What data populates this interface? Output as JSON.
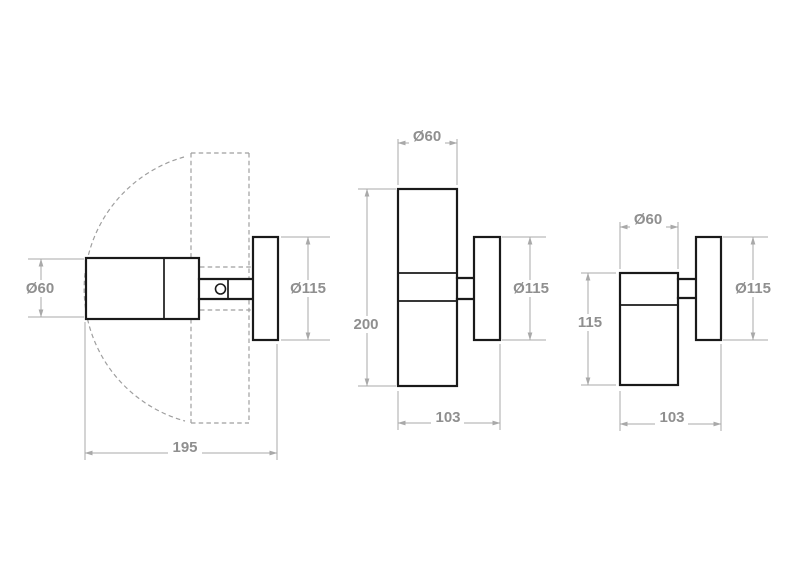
{
  "drawing": {
    "type": "wall-spotlight dimensional drawing, three orthographic views",
    "views": {
      "side": {
        "head_diameter": "Ø60",
        "backplate_diameter": "Ø115",
        "projection": "195"
      },
      "twin": {
        "head_diameter": "Ø60",
        "height": "200",
        "backplate_diameter": "Ø115",
        "depth": "103"
      },
      "single": {
        "head_diameter": "Ø60",
        "height": "115",
        "backplate_diameter": "Ø115",
        "depth": "103"
      }
    },
    "colors": {
      "outline": "#1a1a1a",
      "dimension_lines": "#a9a9a9",
      "dimension_text": "#8f8f8f",
      "dashed_swivel": "#9f9f9f",
      "background": "#ffffff"
    }
  }
}
